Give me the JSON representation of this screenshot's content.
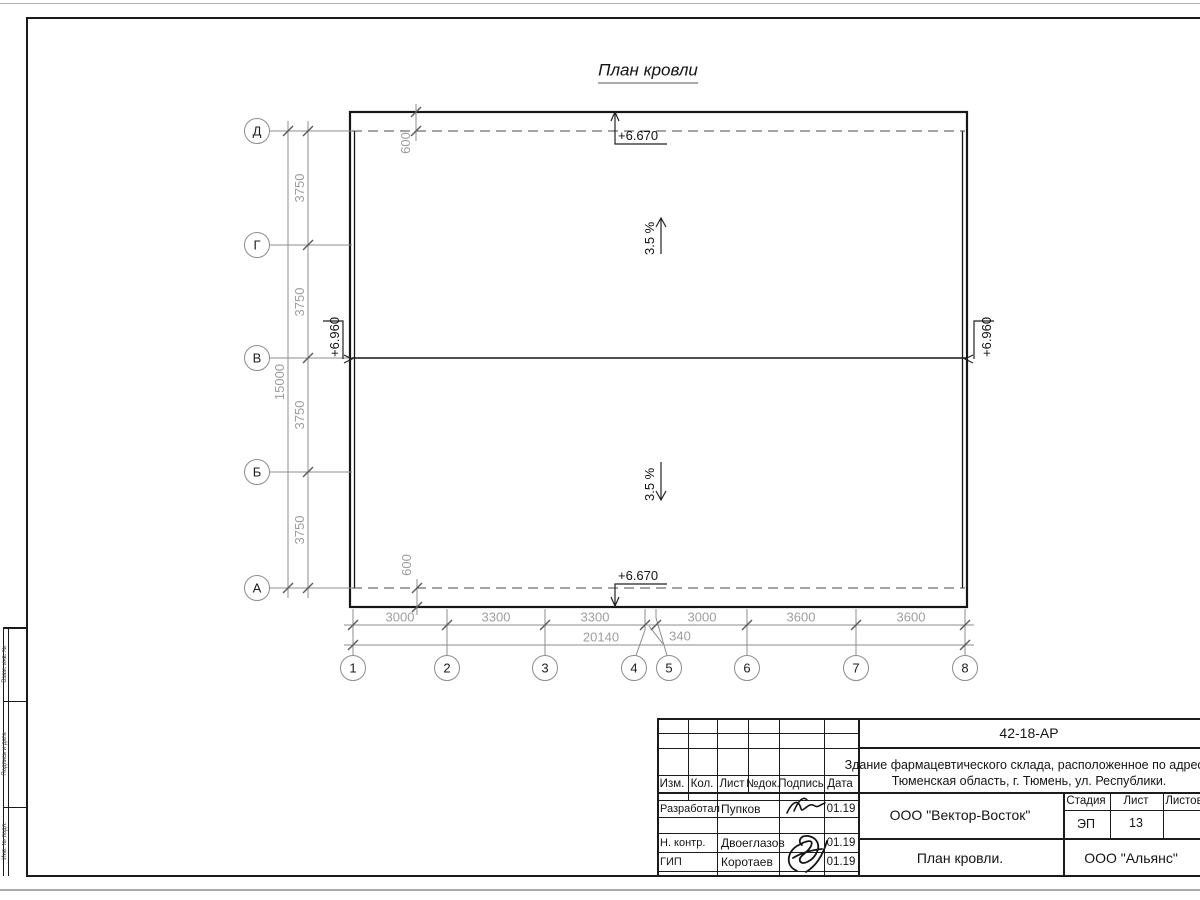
{
  "drawing": {
    "title": "План кровли",
    "axes_horizontal": [
      "Д",
      "Г",
      "В",
      "Б",
      "А"
    ],
    "axes_vertical": [
      "1",
      "2",
      "3",
      "4",
      "5",
      "6",
      "7",
      "8"
    ],
    "dim_left_segments": [
      "3750",
      "3750",
      "3750",
      "3750"
    ],
    "dim_left_total": "15000",
    "dim_bottom_segments": [
      "3000",
      "3300",
      "3300",
      "3000",
      "3600",
      "3600"
    ],
    "dim_bottom_small": "340",
    "dim_bottom_total": "20140",
    "dim_offset_top": "600",
    "dim_offset_bottom": "600",
    "elev_eaves": "+6.670",
    "elev_ridge": "+6.960",
    "slope_up": "3.5 %",
    "slope_down": "3.5 %"
  },
  "title_block": {
    "code": "42-18-АР",
    "project_line1": "Здание фармацевтического склада, расположенное по адресу:",
    "project_line2": "Тюменская область, г. Тюмень, ул. Республики.",
    "col_izm": "Изм.",
    "col_kol": "Кол.",
    "col_list": "Лист",
    "col_doc": "№док.",
    "col_sign": "Подпись",
    "col_date": "Дата",
    "rows": [
      {
        "role": "Разработал",
        "name": "Пупков",
        "date": "01.19"
      },
      {
        "role": "Н. контр.",
        "name": "Двоеглазов",
        "date": "01.19"
      },
      {
        "role": "ГИП",
        "name": "Коротаев",
        "date": "01.19"
      }
    ],
    "org": "ООО \"Вектор-Восток\"",
    "stage_label": "Стадия",
    "sheet_label": "Лист",
    "sheets_label": "Листов",
    "stage": "ЭП",
    "sheet": "13",
    "sheets": "",
    "sheet_title": "План кровли.",
    "client": "ООО \"Альянс\""
  },
  "frame": {
    "side_label_top": "Взам. инв. №",
    "side_label_mid": "Подпись и дата",
    "side_label_bottom": "Инв. № подл."
  },
  "colors": {
    "line_main": "#1b1b1b",
    "line_dim": "#8c8c8c",
    "text_dim": "#9e9e9e",
    "paper_edge": "#b0b0b0"
  }
}
